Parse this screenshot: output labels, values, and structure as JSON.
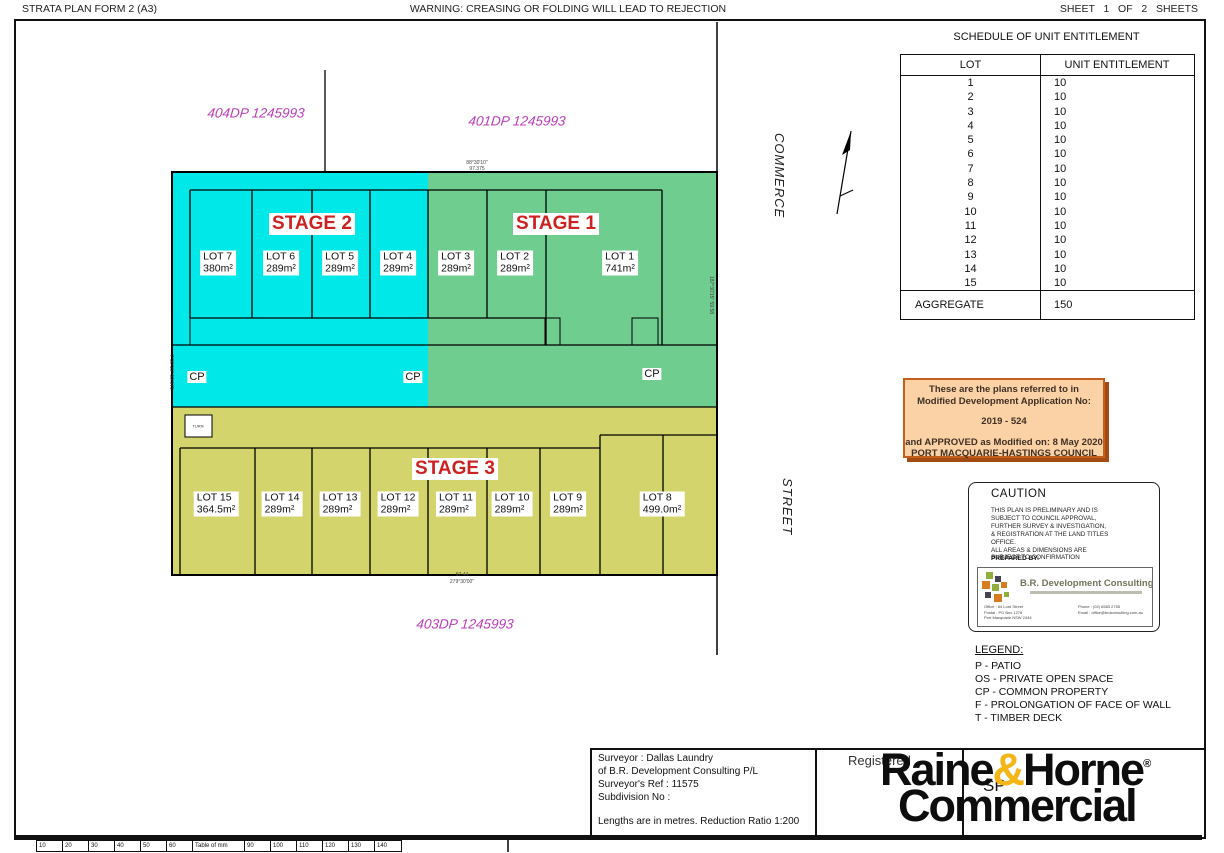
{
  "header": {
    "form_title": "STRATA PLAN FORM 2 (A3)",
    "warning": "WARNING: CREASING OR FOLDING WILL LEAD TO REJECTION",
    "sheet_label": "SHEET   1   OF   2   SHEETS"
  },
  "schedule": {
    "title": "SCHEDULE OF UNIT ENTITLEMENT",
    "col_lot": "LOT",
    "col_value": "UNIT ENTITLEMENT",
    "rows": [
      {
        "lot": "1",
        "value": "10"
      },
      {
        "lot": "2",
        "value": "10"
      },
      {
        "lot": "3",
        "value": "10"
      },
      {
        "lot": "4",
        "value": "10"
      },
      {
        "lot": "5",
        "value": "10"
      },
      {
        "lot": "6",
        "value": "10"
      },
      {
        "lot": "7",
        "value": "10"
      },
      {
        "lot": "8",
        "value": "10"
      },
      {
        "lot": "9",
        "value": "10"
      },
      {
        "lot": "10",
        "value": "10"
      },
      {
        "lot": "11",
        "value": "10"
      },
      {
        "lot": "12",
        "value": "10"
      },
      {
        "lot": "13",
        "value": "10"
      },
      {
        "lot": "14",
        "value": "10"
      },
      {
        "lot": "15",
        "value": "10"
      }
    ],
    "aggregate_label": "AGGREGATE",
    "aggregate_value": "150"
  },
  "plan": {
    "dp_top_left": "404DP 1245993",
    "dp_top_right": "401DP 1245993",
    "dp_bottom": "403DP 1245993",
    "street_name_1": "COMMERCE",
    "street_name_2": "STREET",
    "stage1": "STAGE 1",
    "stage2": "STAGE 2",
    "stage3": "STAGE 3",
    "lots_top": [
      {
        "name": "LOT 7",
        "area": "380m²"
      },
      {
        "name": "LOT 6",
        "area": "289m²"
      },
      {
        "name": "LOT 5",
        "area": "289m²"
      },
      {
        "name": "LOT 4",
        "area": "289m²"
      },
      {
        "name": "LOT 3",
        "area": "289m²"
      },
      {
        "name": "LOT 2",
        "area": "289m²"
      },
      {
        "name": "LOT 1",
        "area": "741m²"
      }
    ],
    "lots_bottom": [
      {
        "name": "LOT 15",
        "area": "364.5m²"
      },
      {
        "name": "LOT 14",
        "area": "289m²"
      },
      {
        "name": "LOT 13",
        "area": "289m²"
      },
      {
        "name": "LOT 12",
        "area": "289m²"
      },
      {
        "name": "LOT 11",
        "area": "289m²"
      },
      {
        "name": "LOT 10",
        "area": "289m²"
      },
      {
        "name": "LOT 9",
        "area": "289m²"
      },
      {
        "name": "LOT 8",
        "area": "499.0m²"
      }
    ],
    "cp1": "CP",
    "cp2": "CP",
    "cp3": "CP",
    "turn_label": "TURN",
    "dim_top_bearing": "88°30'10\"",
    "dim_top_distance": "97.375",
    "dim_bottom_distance": "97.44",
    "dim_bottom_bearing": "279°30'00\"",
    "dim_right": "187°30'15\"  59.58",
    "dim_left": "7°30'15\"  59.575"
  },
  "da_box": {
    "line1": "These are the plans referred to in",
    "line2": "Modified Development Application No:",
    "number": "2019 - 524",
    "line3": "and APPROVED as Modified on: 8 May 2020",
    "line4": "PORT MACQUARIE-HASTINGS COUNCIL"
  },
  "caution": {
    "title": "CAUTION",
    "body": "THIS PLAN IS PRELIMINARY AND IS\nSUBJECT TO COUNCIL APPROVAL,\nFURTHER SURVEY & INVESTIGATION,\n& REGISTRATION AT THE LAND TITLES\nOFFICE.\nALL AREAS & DIMENSIONS ARE\nSUBJECT TO CONFIRMATION",
    "prepared_by": "PREPARED BY:",
    "firm_name": "B.R. Development Consulting",
    "firm_contact_left": "Office : 64 Lord Street\nPostal : PO Box 1276\nPort Macquarie NSW 2444",
    "firm_contact_right": "Phone : (02) 6583 2755\nEmail : office@brdconsulting.com.au"
  },
  "legend": {
    "title": "LEGEND:",
    "items": "P - PATIO\nOS - PRIVATE OPEN SPACE\nCP - COMMON PROPERTY\nF - PROLONGATION OF FACE OF WALL\nT - TIMBER DECK"
  },
  "footer": {
    "surveyor_lines": "Surveyor : Dallas Laundry\nof B.R. Development Consulting P/L\nSurveyor's Ref : 11575\nSubdivision No :",
    "lengths_note": "Lengths are in metres.    Reduction Ratio 1:200",
    "registered": "Registered",
    "sp": "SP",
    "logo_part1": "Raine",
    "logo_amp": "&",
    "logo_part2": "Horne",
    "logo_reg": "®",
    "logo_line2": "Commercial"
  },
  "ruler": {
    "c1": "10",
    "c2": "20",
    "c3": "30",
    "c4": "40",
    "c5": "50",
    "c6": "60",
    "c7": "Table of mm",
    "c8": "90",
    "c9": "100",
    "c10": "110",
    "c11": "120",
    "c12": "130",
    "c13": "140"
  },
  "colors": {
    "stage1_green": "#6fcd8f",
    "stage2_cyan": "#00e8e8",
    "stage3_yellow": "#d4d46c",
    "dp_magenta": "#bb3cbb",
    "stage_red": "#cc2222",
    "approval_fill": "#fad2a6",
    "approval_border": "#c3601d",
    "logo_gold": "#f5b517"
  }
}
